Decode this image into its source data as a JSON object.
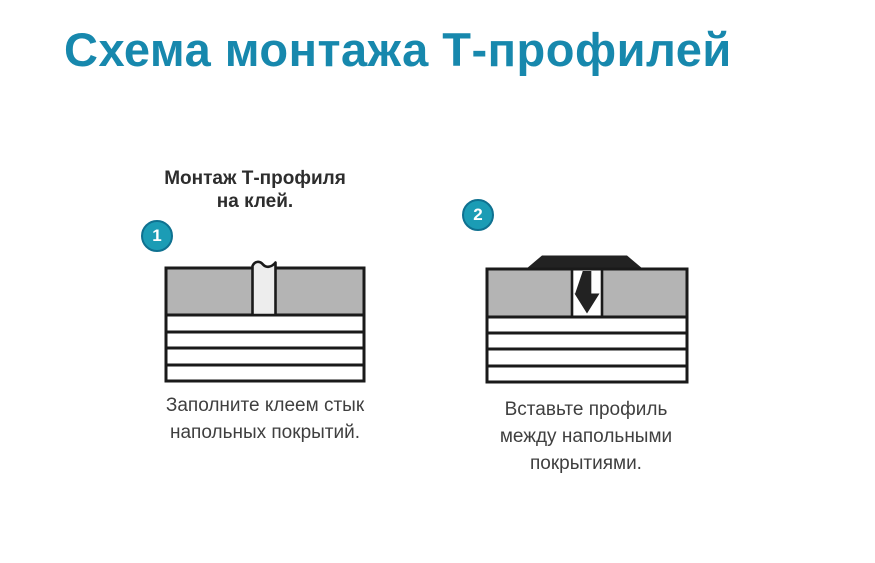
{
  "page": {
    "title": "Схема монтажа Т-профилей"
  },
  "subtitle": {
    "lines": [
      "Монтаж Т-профиля",
      "на клей."
    ]
  },
  "steps": [
    {
      "number": "1",
      "caption_lines": [
        "Заполните клеем стык",
        "напольных покрытий."
      ],
      "diagram": "floor-seam-filled-with-glue"
    },
    {
      "number": "2",
      "caption_lines": [
        "Вставьте профиль",
        "между напольными",
        "покрытиями."
      ],
      "diagram": "t-profile-inserted-into-seam"
    }
  ],
  "colors": {
    "title_teal": "#1788ad",
    "badge_fill": "#1b9cb5",
    "badge_border": "#0f7190",
    "subtitle_text": "#2d2d2d",
    "caption_text": "#3f3f3f",
    "floor_covering_gray": "#b4b4b4",
    "glue_seam_fill": "#ededed",
    "outline_black": "#1a1a1a",
    "profile_black": "#222222",
    "background": "#ffffff"
  }
}
